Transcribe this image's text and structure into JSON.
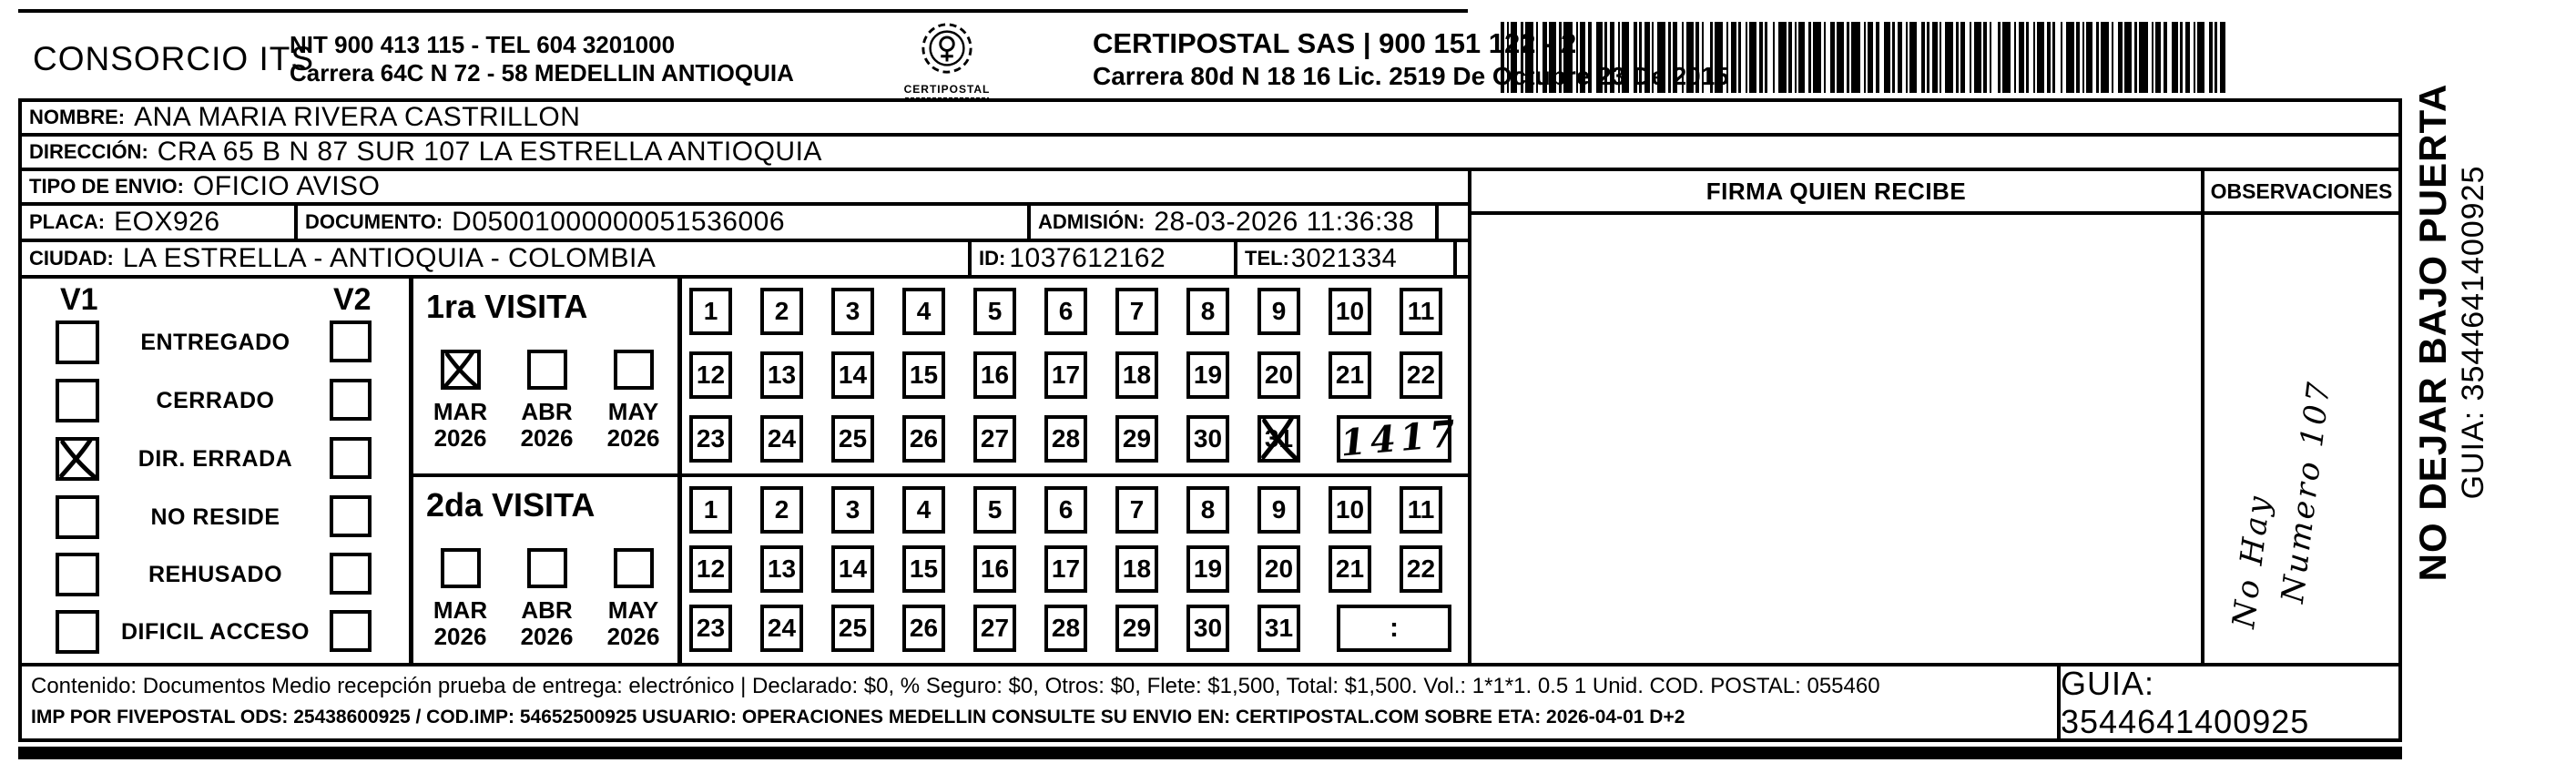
{
  "header": {
    "company": "CONSORCIO ITS",
    "company_nit": "NIT 900 413 115 - TEL 604 3201000",
    "company_address": "Carrera 64C N 72 - 58 MEDELLIN ANTIOQUIA",
    "logo_caption": "CERTIPOSTAL",
    "carrier_line": "CERTIPOSTAL SAS | 900 151 122 - 2",
    "carrier_address": "Carrera 80d N 18 16  Lic. 2519 De Octubre 23 De 2015"
  },
  "shipment": {
    "nombre_label": "NOMBRE:",
    "nombre": "ANA MARIA RIVERA CASTRILLON",
    "direccion_label": "DIRECCIÓN:",
    "direccion": "CRA 65 B N 87 SUR 107 LA ESTRELLA ANTIOQUIA",
    "tipo_envio_label": "TIPO DE ENVIO:",
    "tipo_envio": "OFICIO AVISO",
    "placa_label": "PLACA:",
    "placa": "EOX926",
    "documento_label": "DOCUMENTO:",
    "documento": "D05001000000051536006",
    "admision_label": "ADMISIÓN:",
    "admision": "28-03-2026 11:36:38",
    "ciudad_label": "CIUDAD:",
    "ciudad": "LA ESTRELLA - ANTIOQUIA - COLOMBIA",
    "id_label": "ID:",
    "id_value": "1037612162",
    "tel_label": "TEL:",
    "tel_value": "3021334"
  },
  "firma_header": "FIRMA QUIEN RECIBE",
  "observaciones": {
    "header": "OBSERVACIONES",
    "handwritten_line1": "No Hay",
    "handwritten_line2": "Numero 107"
  },
  "status_panel": {
    "visit1_col": "V1",
    "visit2_col": "V2",
    "items": [
      {
        "label": "ENTREGADO",
        "v1": false,
        "v2": false
      },
      {
        "label": "CERRADO",
        "v1": false,
        "v2": false
      },
      {
        "label": "DIR. ERRADA",
        "v1": true,
        "v2": false
      },
      {
        "label": "NO RESIDE",
        "v1": false,
        "v2": false
      },
      {
        "label": "REHUSADO",
        "v1": false,
        "v2": false
      },
      {
        "label": "DIFICIL ACCESO",
        "v1": false,
        "v2": false
      }
    ]
  },
  "visita1": {
    "title": "1ra VISITA",
    "months": [
      {
        "label": "MAR",
        "year": "2026",
        "checked": true
      },
      {
        "label": "ABR",
        "year": "2026",
        "checked": false
      },
      {
        "label": "MAY",
        "year": "2026",
        "checked": false
      }
    ],
    "day_rows": [
      [
        "1",
        "2",
        "3",
        "4",
        "5",
        "6",
        "7",
        "8",
        "9",
        "10",
        "11"
      ],
      [
        "12",
        "13",
        "14",
        "15",
        "16",
        "17",
        "18",
        "19",
        "20",
        "21",
        "22"
      ],
      [
        "23",
        "24",
        "25",
        "26",
        "27",
        "28",
        "29",
        "30",
        "31"
      ]
    ],
    "crossed_day": "31",
    "time_box_value": "1417",
    "time_box_handwritten": true
  },
  "visita2": {
    "title": "2da VISITA",
    "months": [
      {
        "label": "MAR",
        "year": "2026",
        "checked": false
      },
      {
        "label": "ABR",
        "year": "2026",
        "checked": false
      },
      {
        "label": "MAY",
        "year": "2026",
        "checked": false
      }
    ],
    "day_rows": [
      [
        "1",
        "2",
        "3",
        "4",
        "5",
        "6",
        "7",
        "8",
        "9",
        "10",
        "11"
      ],
      [
        "12",
        "13",
        "14",
        "15",
        "16",
        "17",
        "18",
        "19",
        "20",
        "21",
        "22"
      ],
      [
        "23",
        "24",
        "25",
        "26",
        "27",
        "28",
        "29",
        "30",
        "31"
      ]
    ],
    "crossed_day": "",
    "time_box_value": ":",
    "time_box_handwritten": false
  },
  "footer": {
    "content_line": "Contenido: Documentos Medio recepción prueba de entrega: electrónico | Declarado: $0, % Seguro: $0, Otros: $0, Flete: $1,500, Total: $1,500. Vol.: 1*1*1. 0.5  1 Unid. COD. POSTAL: 055460",
    "imp_line": "IMP POR FIVEPOSTAL ODS: 25438600925 / COD.IMP: 54652500925 USUARIO: OPERACIONES MEDELLIN CONSULTE SU ENVIO EN: CERTIPOSTAL.COM SOBRE ETA: 2026-04-01 D+2",
    "guia": "GUIA: 3544641400925"
  },
  "side_note": {
    "line1": "NO DEJAR BAJO PUERTA",
    "line2": "GUIA: 3544641400925"
  },
  "colors": {
    "ink": "#000000",
    "paper": "#ffffff"
  }
}
